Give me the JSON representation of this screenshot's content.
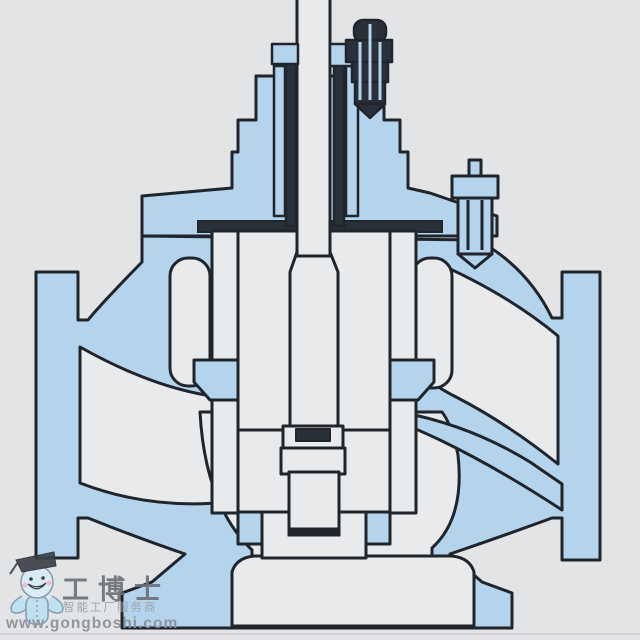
{
  "diagram": {
    "kind": "control-valve-cross-section",
    "style": "engineering-cutaway-drawing",
    "palette": {
      "background": "#e3e4e6",
      "section_fill": "#b4d3ec",
      "cavity_fill": "#e9eaec",
      "outline": "#20252c",
      "hardware_dark": "#2a3039"
    },
    "components": [
      "valve-stem",
      "packing-studs",
      "top-stud-bolt",
      "bonnet",
      "bonnet-gasket",
      "side-stud-fitting",
      "valve-body-with-flanges",
      "inlet-flange",
      "outlet-flange",
      "cage",
      "seat-rings",
      "valve-plug",
      "plug-seal-ring",
      "guide-boss",
      "bottom-cover"
    ]
  },
  "watermark": {
    "brand": "工博士",
    "tagline": "智能工厂服务商",
    "url": "www.gongboshi.com",
    "mascot": "robot-graduate-mascot"
  }
}
